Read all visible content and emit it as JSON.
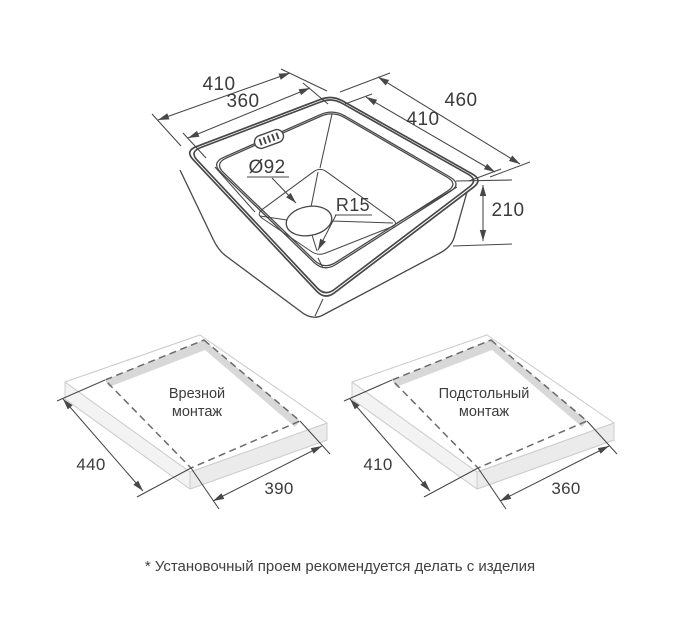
{
  "sink_view": {
    "description": "Isometric technical drawing of square kitchen sink",
    "dimensions": {
      "outer_width": "410",
      "inner_width": "360",
      "outer_depth": "460",
      "inner_depth": "410",
      "drain_diameter": "Ø92",
      "corner_radius": "R15",
      "height": "210"
    }
  },
  "mount_left": {
    "title_line1": "Врезной",
    "title_line2": "монтаж",
    "dim_side": "440",
    "dim_front": "390"
  },
  "mount_right": {
    "title_line1": "Подстольный",
    "title_line2": "монтаж",
    "dim_side": "410",
    "dim_front": "360"
  },
  "footnote": "* Установочный проем рекомендуется делать с изделия",
  "colors": {
    "line": "#474747",
    "text": "#3c3c3c",
    "slab_outline": "#cdcdcd",
    "slab_side_left": "#f3f3f3",
    "slab_side_right": "#ebebeb",
    "cutout_dash": "#6b6b6b",
    "cutout_shade": "#d8d8d8",
    "background": "#ffffff"
  }
}
